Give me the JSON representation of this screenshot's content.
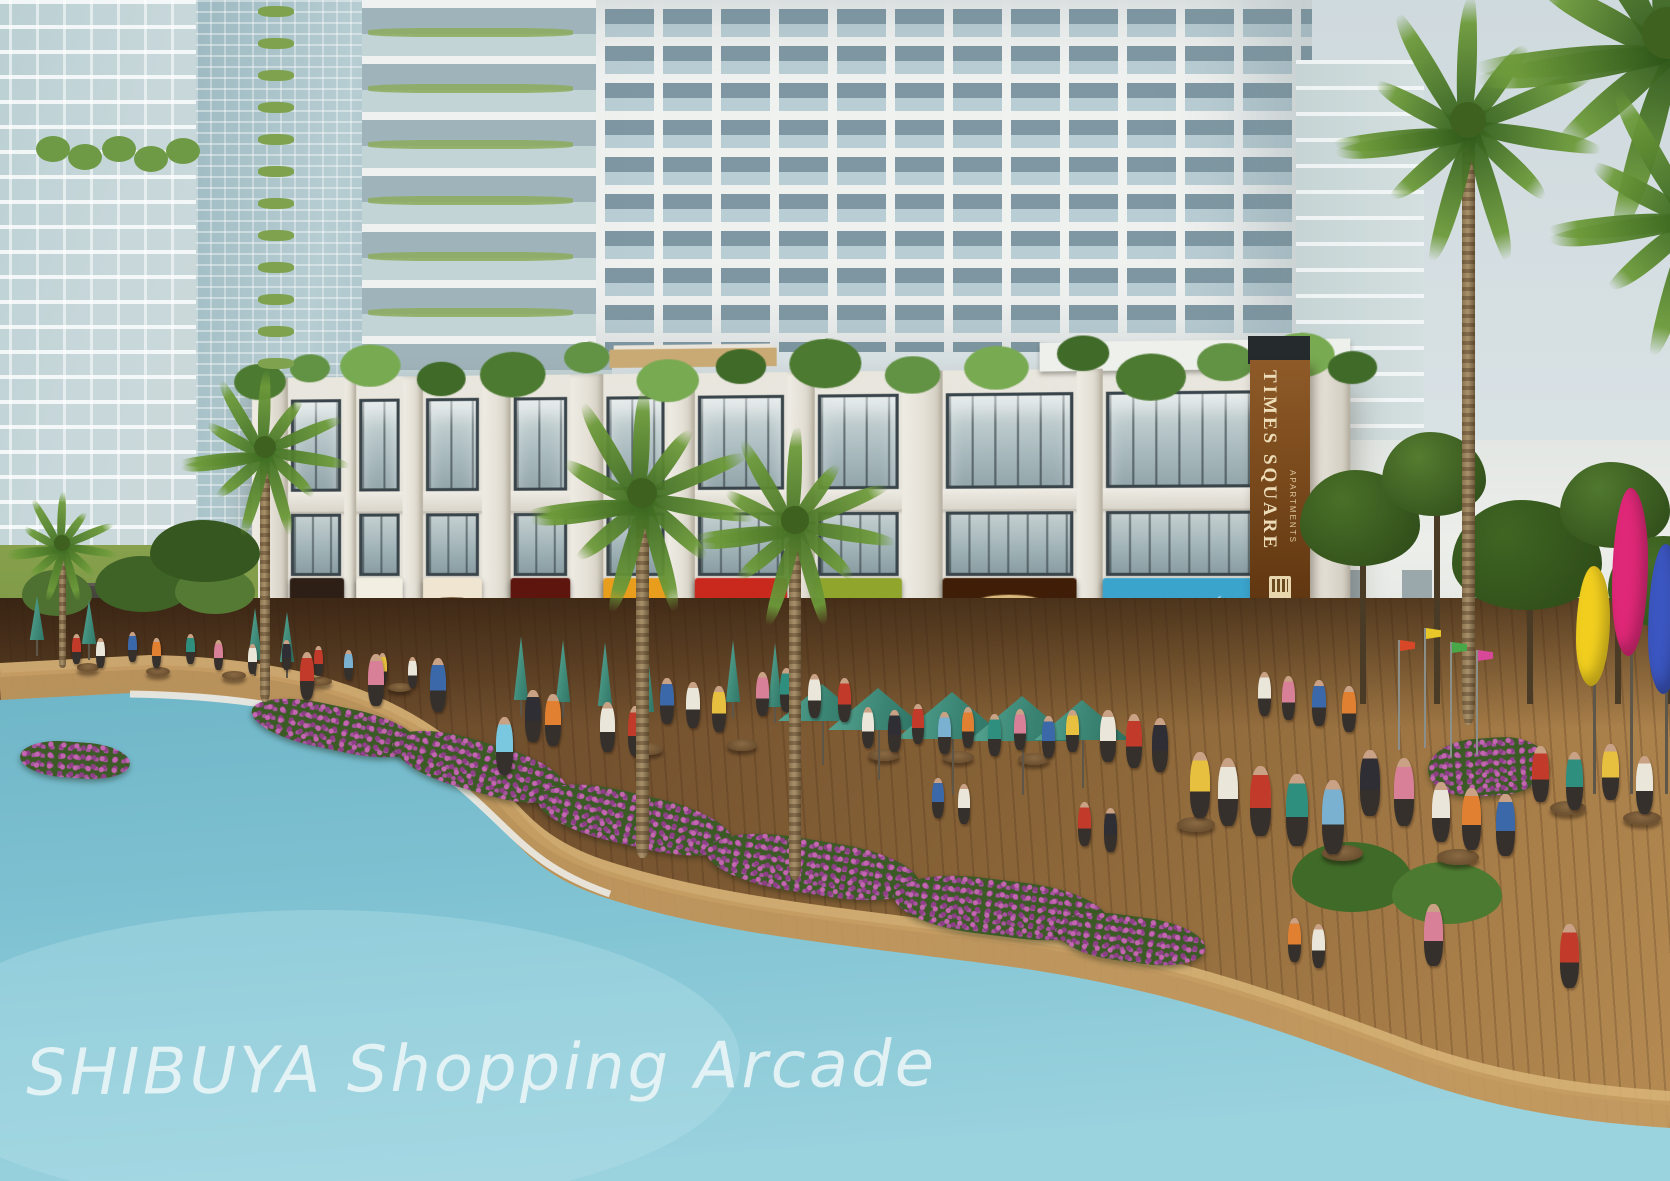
{
  "watermark": "SHIBUYA Shopping Arcade",
  "banner": {
    "title": "TIMES SQUARE",
    "subtitle": "APARTMENTS"
  },
  "storefronts": [
    {
      "name": "HOUSE",
      "x": 38,
      "w": 54,
      "bg": "#2e1f16",
      "fg": "#dccdb4",
      "style": "caps"
    },
    {
      "name": "Shop Food",
      "x": 104,
      "w": 46,
      "bg": "#f2efe2",
      "fg": "#7ab232",
      "fg2": "#c8352a",
      "style": "twotone"
    },
    {
      "name": "Софра",
      "x": 170,
      "w": 58,
      "bg": "#efe5d0",
      "fg": "#f2e8d2",
      "pill": "#6e4a28",
      "style": "pill"
    },
    {
      "name": "Jalapenos",
      "x": 256,
      "w": 58,
      "bg": "#5d150e",
      "fg": "#e8b052",
      "style": "script"
    },
    {
      "name": "ThaiChef",
      "x": 346,
      "w": 62,
      "bg": "#e89d1d",
      "fg": "#fdf6da",
      "style": "hat"
    },
    {
      "name": "Awesome",
      "line2": "Shawarma",
      "x": 434,
      "w": 88,
      "bg": "#c9281c",
      "fg": "#ffffff",
      "fg2": "#f6d44a",
      "style": "twoline"
    },
    {
      "name": "Alfredo's",
      "tagline": "casa della pasta",
      "x": 548,
      "w": 82,
      "bg": "#8fa52c",
      "fg": "#ffffff",
      "fg2": "#eaf2c2",
      "style": "hat"
    },
    {
      "name": "Baroma",
      "x": 668,
      "w": 124,
      "bg": "#3f1d06",
      "fg": "#42200a",
      "pill": "#d9b87c",
      "style": "pill"
    },
    {
      "name": "Underbelly",
      "x": 816,
      "w": 168,
      "bg": "#3aa4cd",
      "fg": "#f2fbfd",
      "style": "whale"
    }
  ],
  "scene": {
    "colors": {
      "water": "#7fc2d2",
      "deck": "#8a6538",
      "umbrella": "#3d8877",
      "concrete": "#e9e6de",
      "bannerBrown": "#7a4a1c",
      "flower": "#a855a0",
      "palm": "#456f24"
    },
    "arcade": {
      "piers": [
        [
          0,
          36
        ],
        [
          92,
          12
        ],
        [
          150,
          20
        ],
        [
          228,
          28
        ],
        [
          314,
          32
        ],
        [
          408,
          26
        ],
        [
          522,
          26
        ],
        [
          630,
          38
        ],
        [
          792,
          24
        ],
        [
          984,
          56
        ]
      ],
      "bays": [
        [
          36,
          56
        ],
        [
          104,
          46
        ],
        [
          170,
          58
        ],
        [
          256,
          58
        ],
        [
          346,
          62
        ],
        [
          434,
          88
        ],
        [
          548,
          82
        ],
        [
          668,
          124
        ],
        [
          816,
          168
        ]
      ],
      "roofTufts": [
        [
          8,
          26
        ],
        [
          58,
          20
        ],
        [
          118,
          30
        ],
        [
          188,
          24
        ],
        [
          258,
          32
        ],
        [
          330,
          22
        ],
        [
          408,
          30
        ],
        [
          478,
          24
        ],
        [
          558,
          34
        ],
        [
          640,
          26
        ],
        [
          718,
          30
        ],
        [
          798,
          24
        ],
        [
          860,
          32
        ],
        [
          928,
          26
        ],
        [
          996,
          30
        ],
        [
          1042,
          22
        ]
      ]
    },
    "towerPlants": {
      "aTufts": [
        [
          52,
          150
        ],
        [
          84,
          158
        ],
        [
          118,
          150
        ],
        [
          150,
          160
        ],
        [
          182,
          152
        ]
      ],
      "bColumn": {
        "x": 258,
        "w": 36,
        "h": 11,
        "y0": 6,
        "step": 32,
        "rows": 12
      },
      "cRows": {
        "x": 368,
        "w": 205,
        "h": 9,
        "y0": 28,
        "step": 56,
        "rows": 6
      }
    },
    "openUmbrellas": [
      [
        822,
        684,
        88
      ],
      [
        878,
        688,
        100
      ],
      [
        952,
        692,
        112
      ],
      [
        1022,
        696,
        108
      ],
      [
        1082,
        700,
        96
      ]
    ],
    "closedUmbrellas": [
      [
        36,
        596,
        44
      ],
      [
        88,
        600,
        44
      ],
      [
        254,
        608,
        52
      ],
      [
        286,
        612,
        50
      ],
      [
        520,
        636,
        64
      ],
      [
        562,
        640,
        62
      ],
      [
        604,
        642,
        64
      ],
      [
        646,
        646,
        66
      ],
      [
        732,
        640,
        62
      ],
      [
        774,
        643,
        64
      ]
    ],
    "tables": [
      [
        88,
        668
      ],
      [
        158,
        672
      ],
      [
        234,
        676
      ],
      [
        320,
        682
      ],
      [
        400,
        688
      ],
      [
        648,
        748
      ],
      [
        742,
        744
      ],
      [
        884,
        754
      ],
      [
        958,
        756
      ],
      [
        1034,
        758
      ],
      [
        1196,
        822
      ],
      [
        1342,
        850
      ],
      [
        1458,
        854
      ],
      [
        1568,
        806
      ],
      [
        1642,
        816
      ]
    ],
    "figures": [
      [
        72,
        664,
        "#c23b2a"
      ],
      [
        96,
        668,
        "#eae6da"
      ],
      [
        128,
        662,
        "#3a68a8"
      ],
      [
        152,
        668,
        "#e08030"
      ],
      [
        186,
        664,
        "#2f8f7f"
      ],
      [
        214,
        670,
        "#d88098"
      ],
      [
        248,
        674,
        "#eae6da"
      ],
      [
        282,
        670,
        "#2e2e34"
      ],
      [
        314,
        676,
        "#c23b2a"
      ],
      [
        344,
        680,
        "#7ab0d0"
      ],
      [
        378,
        684,
        "#e8c040"
      ],
      [
        408,
        688,
        "#eae6da"
      ],
      [
        368,
        706,
        "#d88098",
        52
      ],
      [
        430,
        712,
        "#3a68a8",
        54
      ],
      [
        300,
        700,
        "#c23b2a",
        48
      ],
      [
        496,
        775,
        "#7ac8e0",
        58
      ],
      [
        525,
        742,
        "#2e2e34",
        52
      ],
      [
        545,
        746,
        "#e08030",
        52
      ],
      [
        600,
        752,
        "#eae6da",
        50
      ],
      [
        628,
        756,
        "#c23b2a",
        50
      ],
      [
        660,
        724,
        "#3a68a8",
        46
      ],
      [
        686,
        728,
        "#eae6da",
        46
      ],
      [
        712,
        732,
        "#e8c040",
        46
      ],
      [
        756,
        716,
        "#d88098",
        44
      ],
      [
        780,
        712,
        "#2f8f7f",
        44
      ],
      [
        808,
        718,
        "#eae6da",
        44
      ],
      [
        838,
        722,
        "#c23b2a",
        44
      ],
      [
        862,
        748,
        "#eae6da"
      ],
      [
        888,
        752,
        "#2e2e34"
      ],
      [
        912,
        744,
        "#c23b2a"
      ],
      [
        938,
        754,
        "#7ab0d0"
      ],
      [
        962,
        748,
        "#e08030"
      ],
      [
        988,
        756,
        "#2f8f7f"
      ],
      [
        1014,
        750,
        "#d88098"
      ],
      [
        1042,
        758,
        "#3a68a8"
      ],
      [
        1066,
        752,
        "#e8c040"
      ],
      [
        1100,
        762,
        "#eae6da",
        52
      ],
      [
        1126,
        768,
        "#c23b2a",
        54
      ],
      [
        1152,
        772,
        "#2e2e34",
        54
      ],
      [
        1258,
        716,
        "#eae6da",
        44
      ],
      [
        1282,
        720,
        "#d88098",
        44
      ],
      [
        1312,
        726,
        "#3a68a8",
        46
      ],
      [
        1342,
        732,
        "#e08030",
        46
      ],
      [
        1190,
        818,
        "#e8c040",
        66
      ],
      [
        1218,
        826,
        "#eae6da",
        68
      ],
      [
        1250,
        836,
        "#c23b2a",
        70
      ],
      [
        1286,
        846,
        "#2f8f7f",
        72
      ],
      [
        1322,
        854,
        "#7ab0d0",
        74
      ],
      [
        1360,
        816,
        "#2e2e34",
        66
      ],
      [
        1394,
        826,
        "#d88098",
        68
      ],
      [
        1432,
        842,
        "#eae6da",
        60
      ],
      [
        1462,
        850,
        "#e08030",
        62
      ],
      [
        1496,
        856,
        "#3a68a8",
        62
      ],
      [
        1532,
        802,
        "#c23b2a",
        56
      ],
      [
        1566,
        810,
        "#2f8f7f",
        58
      ],
      [
        1602,
        800,
        "#e8c040",
        56
      ],
      [
        1636,
        814,
        "#eae6da",
        58
      ],
      [
        932,
        818,
        "#3a68a8",
        40
      ],
      [
        958,
        824,
        "#eae6da",
        40
      ],
      [
        1078,
        846,
        "#c23b2a",
        44
      ],
      [
        1104,
        852,
        "#2e2e34",
        44
      ],
      [
        1288,
        962,
        "#e08030",
        44
      ],
      [
        1312,
        968,
        "#eae6da",
        44
      ],
      [
        1424,
        966,
        "#d88098",
        62
      ],
      [
        1560,
        988,
        "#c23b2a",
        64
      ]
    ],
    "flowerPatches": [
      [
        250,
        706,
        170,
        44,
        12
      ],
      [
        390,
        742,
        180,
        50,
        16
      ],
      [
        535,
        794,
        200,
        52,
        13
      ],
      [
        705,
        840,
        215,
        54,
        9
      ],
      [
        893,
        880,
        215,
        56,
        7
      ],
      [
        1056,
        916,
        150,
        46,
        8
      ],
      [
        1428,
        738,
        120,
        58,
        -4
      ],
      [
        20,
        742,
        110,
        36,
        4
      ]
    ],
    "bushes": [
      [
        22,
        570,
        70,
        46,
        "#4e7030"
      ],
      [
        95,
        556,
        96,
        56,
        "#3f6226"
      ],
      [
        175,
        566,
        80,
        48,
        "#557a34"
      ],
      [
        150,
        520,
        110,
        62,
        "#36571f"
      ],
      [
        1292,
        842,
        120,
        70,
        "#3f6a28"
      ],
      [
        1392,
        862,
        110,
        62,
        "#4c7a30"
      ]
    ],
    "rightTrees": [
      [
        1300,
        470,
        120,
        96,
        "#4a7028"
      ],
      [
        1382,
        432,
        104,
        84,
        "#557c30"
      ],
      [
        1452,
        500,
        150,
        110,
        "#3f6522"
      ],
      [
        1560,
        462,
        110,
        86,
        "#50782e"
      ],
      [
        1608,
        536,
        120,
        92,
        "#456d26"
      ]
    ],
    "palms": [
      {
        "cx": 265,
        "cy": 452,
        "r": 88,
        "tw": 10,
        "th": 250,
        "c": "#3e6d22"
      },
      {
        "cx": 642,
        "cy": 498,
        "r": 118,
        "tw": 13,
        "th": 360,
        "c": "#3a661f"
      },
      {
        "cx": 795,
        "cy": 525,
        "r": 105,
        "tw": 12,
        "th": 355,
        "c": "#456f24"
      },
      {
        "cx": 1468,
        "cy": 125,
        "r": 140,
        "tw": 13,
        "th": 600,
        "c": "#2f5a1a"
      },
      {
        "cx": 62,
        "cy": 548,
        "r": 58,
        "tw": 7,
        "th": 120,
        "c": "#3e6d22"
      },
      {
        "cx": 1668,
        "cy": 38,
        "r": 200,
        "tw": 0,
        "th": 0,
        "c": "#2c5418"
      },
      {
        "cx": 1692,
        "cy": 210,
        "r": 150,
        "tw": 0,
        "th": 0,
        "c": "#35611d"
      }
    ],
    "sculptures": [
      [
        1576,
        566,
        34,
        120,
        "#f2cf1f"
      ],
      [
        1612,
        488,
        36,
        168,
        "#e02878"
      ],
      [
        1648,
        544,
        34,
        150,
        "#3b56c0"
      ]
    ],
    "flags": [
      [
        1398,
        640,
        110,
        "#d84828"
      ],
      [
        1424,
        628,
        120,
        "#e8c828"
      ],
      [
        1450,
        642,
        115,
        "#48a848"
      ],
      [
        1476,
        650,
        105,
        "#d84898"
      ]
    ]
  }
}
